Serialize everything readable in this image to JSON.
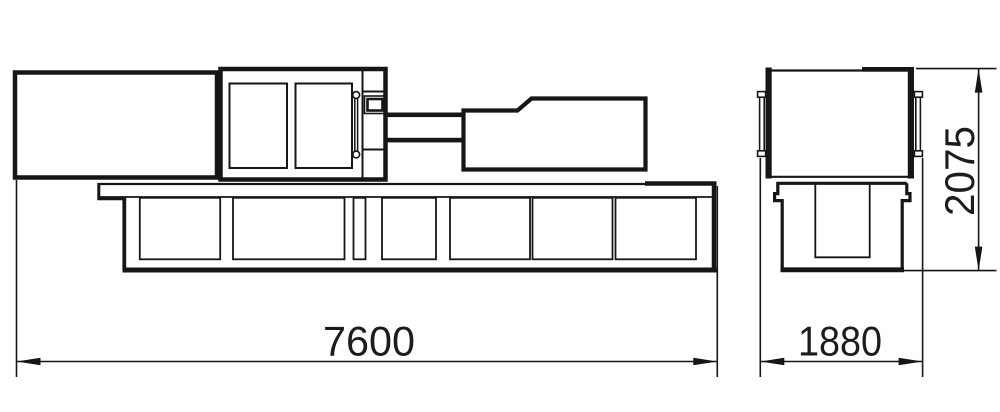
{
  "drawing": {
    "background_color": "#ffffff",
    "line_color": "#161616",
    "dimension_labels": {
      "side_view_length": "7600",
      "end_view_width": "1880",
      "end_view_height": "2075"
    }
  }
}
